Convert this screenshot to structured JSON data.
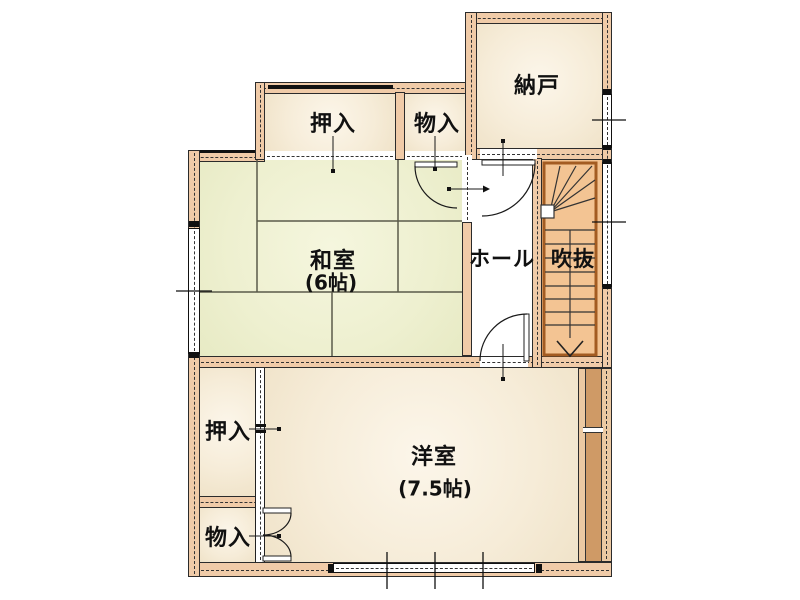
{
  "floorplan": {
    "labels": {
      "nando": "納戸",
      "oshiire_top": "押入",
      "monoire_top": "物入",
      "washitsu": "和室",
      "washitsu_size": "(6帖)",
      "hall": "ホール",
      "fukinuke": "吹抜",
      "oshiire_left": "押入",
      "monoire_bottom": "物入",
      "yoshitsu": "洋室",
      "yoshitsu_size": "(7.5帖)"
    },
    "colors": {
      "wall": "#f0cba8",
      "tatami": "#eef0d0",
      "room_cream": "#f7efdd",
      "stairs": "#f3c493",
      "stair_border": "#a35c22",
      "dark_band": "#cf9a66",
      "line": "#1a1a1a"
    }
  }
}
